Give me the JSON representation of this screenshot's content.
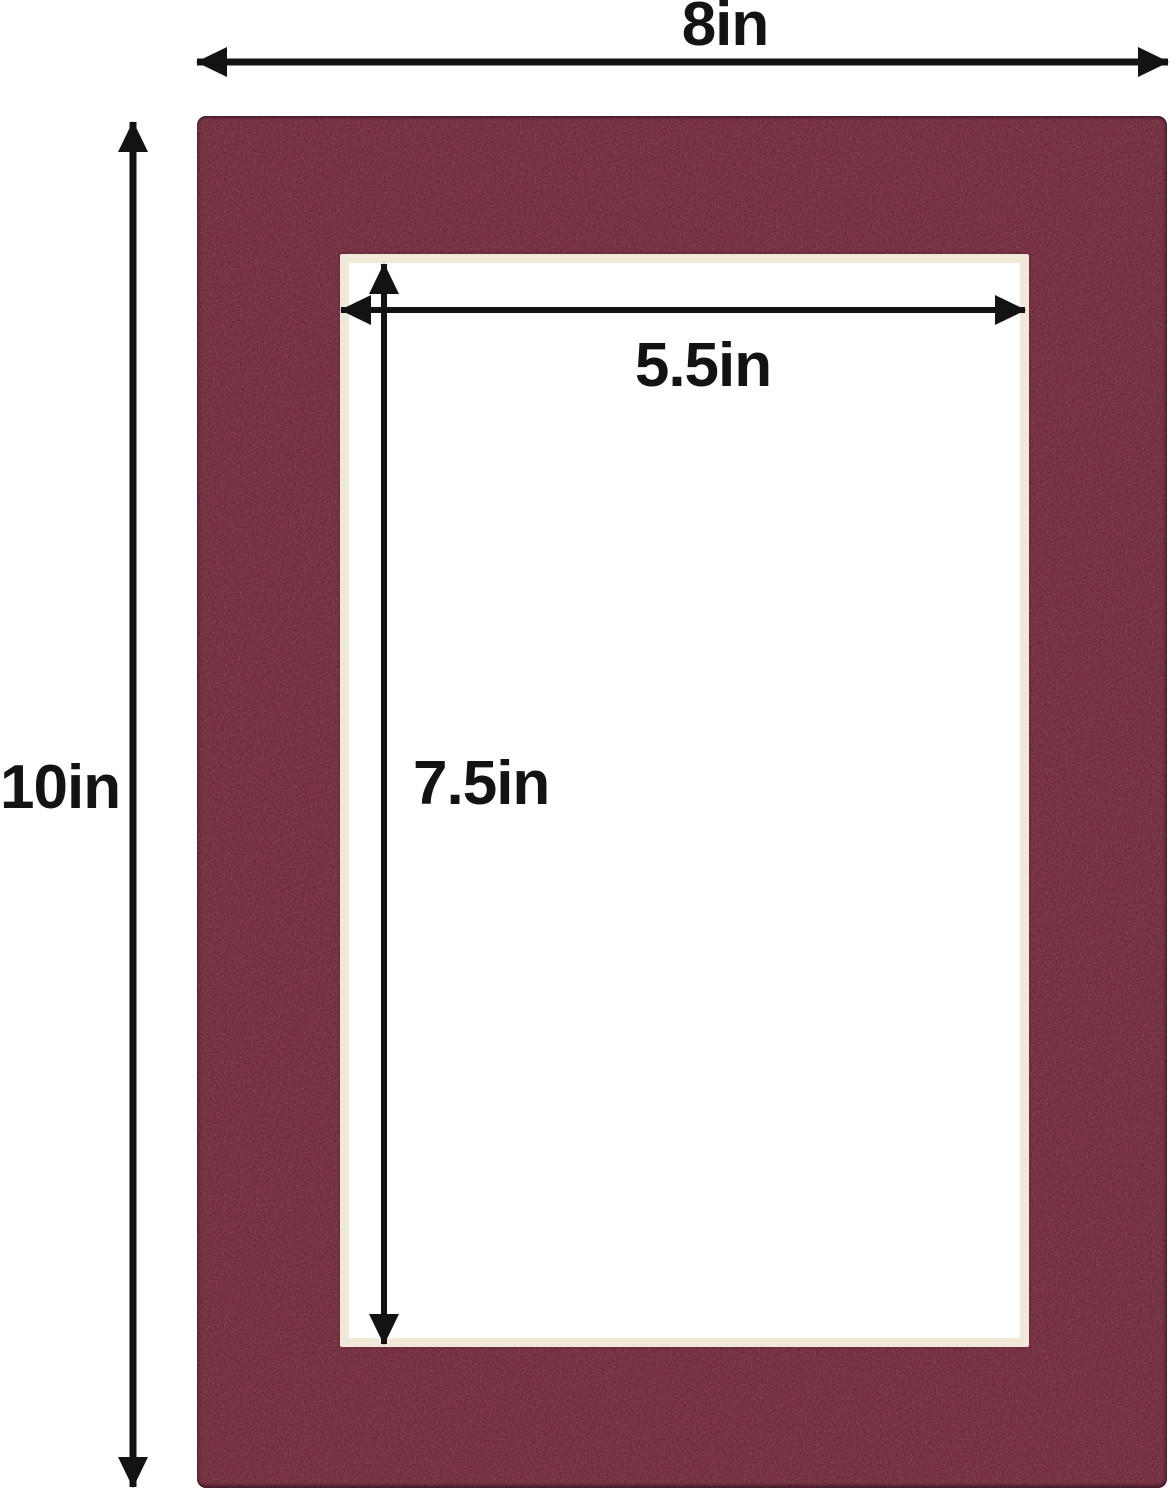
{
  "diagram": {
    "outer_width_label": "8in",
    "outer_height_label": "10in",
    "opening_width_label": "5.5in",
    "opening_height_label": "7.5in"
  },
  "colors": {
    "mat": "#7d3345",
    "bevel": "#f1e9d8",
    "opening": "#ffffff",
    "arrow": "#131313",
    "background": "#ffffff"
  }
}
